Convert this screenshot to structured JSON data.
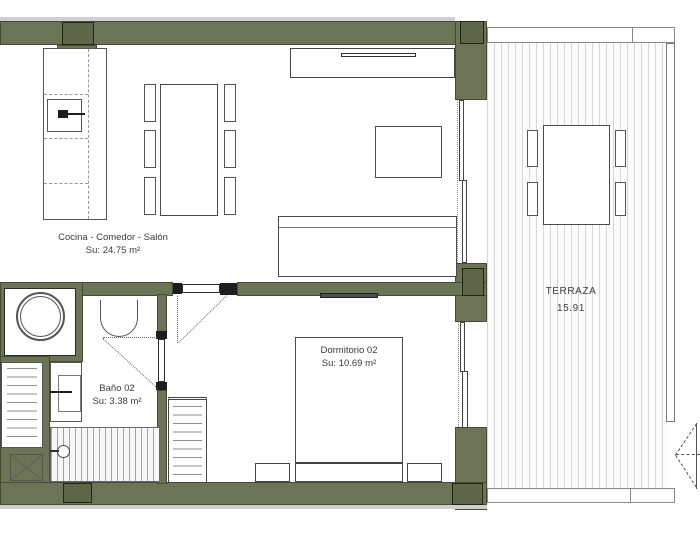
{
  "plan": {
    "rooms": {
      "living": {
        "name": "Cocina - Comedor - Salón",
        "area": "Su:  24.75 m²"
      },
      "bath": {
        "name": "Baño 02",
        "area": "Su:  3.38 m²"
      },
      "bedroom": {
        "name": "Dormitorio 02",
        "area": "Su:  10.69 m²"
      },
      "terrace": {
        "name": "TERRAZA",
        "area": "15.91"
      }
    },
    "colors": {
      "wall": "#6d7456",
      "wall_dark": "#5d6747",
      "wall_border": "#454c36",
      "deck_stripe": "#d6d6d6"
    }
  }
}
